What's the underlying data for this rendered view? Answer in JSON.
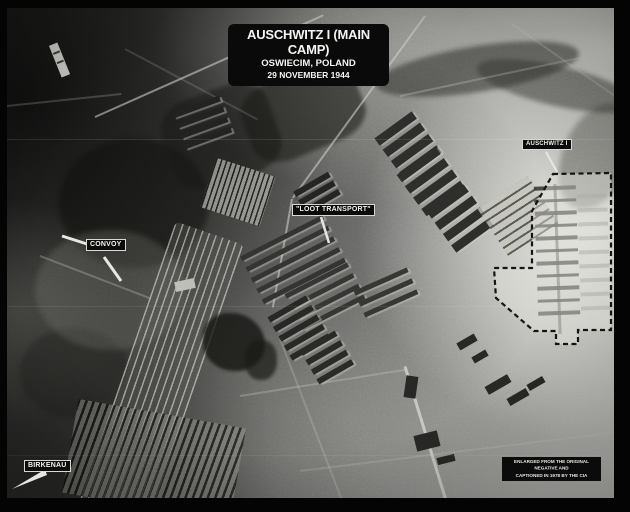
{
  "photo": {
    "type": "black-and-white aerial reconnaissance photograph",
    "subject": "Auschwitz I main camp and surroundings, railway yard lower left, overexposed bright area on right"
  },
  "title_box": {
    "line1": "AUSCHWITZ I (MAIN CAMP)",
    "line2": "OSWIECIM, POLAND",
    "line3": "29 NOVEMBER 1944"
  },
  "labels": {
    "auschwitz_i": "AUSCHWITZ I",
    "loot_transport": "\"LOOT TRANSPORT\"",
    "convoy": "CONVOY",
    "birkenau": "BIRKENAU"
  },
  "caption": {
    "line1": "ENLARGED FROM THE ORIGINAL NEGATIVE AND",
    "line2": "CAPTIONED IN 1978 BY THE CIA"
  },
  "colors": {
    "frame": "#000000",
    "label_background": "#0c0c0c",
    "label_border": "#d8d8d4",
    "label_text": "#f2f2ee",
    "dashed_boundary": "#141414",
    "leader_lines": "#e6e6e2"
  }
}
